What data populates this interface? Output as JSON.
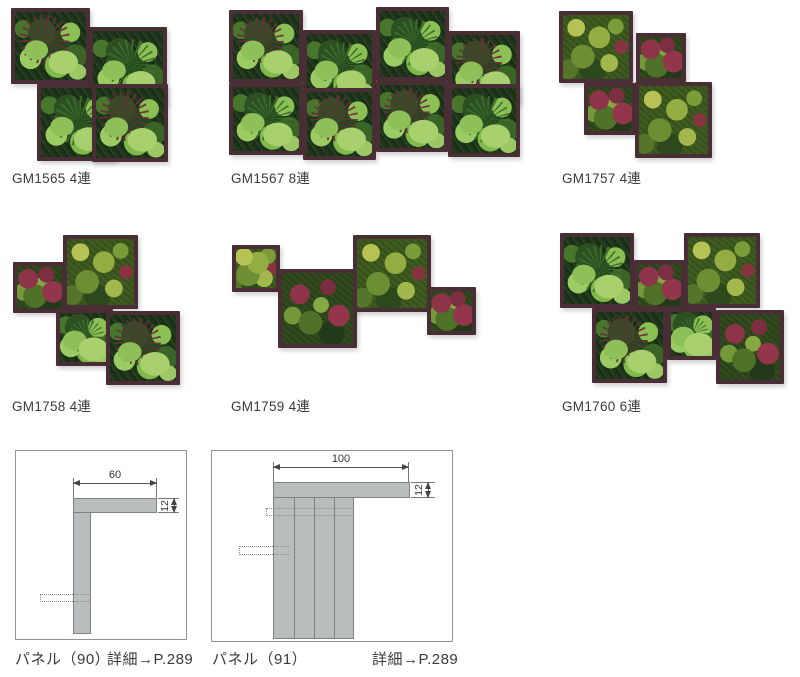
{
  "colors": {
    "frame": "#4a2e35",
    "text": "#3a3a3a",
    "box_border": "#8f9497",
    "diagram_fill": "#b9bdbe",
    "diagram_stroke": "#7e8284",
    "foliage_palette": [
      "#1d3519",
      "#2d5022",
      "#47762c",
      "#7fb94a",
      "#9ccb63",
      "#b7c254",
      "#93ad42",
      "#6d2c3c",
      "#8d3448",
      "#93354b"
    ]
  },
  "products": [
    {
      "code_label": "GM1565 4連",
      "label_pos": {
        "x": 12,
        "y": 167
      },
      "tiles": [
        {
          "x": 11,
          "y": 8,
          "w": 79,
          "h": 76,
          "variant": "jungle",
          "spike": "red"
        },
        {
          "x": 89,
          "y": 27,
          "w": 78,
          "h": 78,
          "variant": "jungle",
          "spike": "green"
        },
        {
          "x": 37,
          "y": 84,
          "w": 78,
          "h": 77,
          "variant": "jungle",
          "spike": "green"
        },
        {
          "x": 92,
          "y": 84,
          "w": 76,
          "h": 78,
          "variant": "jungle",
          "spike": "red"
        }
      ]
    },
    {
      "code_label": "GM1567 8連",
      "label_pos": {
        "x": 231,
        "y": 167
      },
      "tiles": [
        {
          "x": 229,
          "y": 10,
          "w": 74,
          "h": 73,
          "variant": "jungle",
          "spike": "red"
        },
        {
          "x": 303,
          "y": 30,
          "w": 73,
          "h": 73,
          "variant": "jungle",
          "spike": "green"
        },
        {
          "x": 376,
          "y": 7,
          "w": 73,
          "h": 74,
          "variant": "jungle",
          "spike": "green"
        },
        {
          "x": 448,
          "y": 31,
          "w": 72,
          "h": 73,
          "variant": "jungle",
          "spike": "red"
        },
        {
          "x": 229,
          "y": 83,
          "w": 74,
          "h": 72,
          "variant": "jungle",
          "spike": "green"
        },
        {
          "x": 303,
          "y": 88,
          "w": 73,
          "h": 72,
          "variant": "jungle",
          "spike": "red"
        },
        {
          "x": 376,
          "y": 81,
          "w": 72,
          "h": 71,
          "variant": "jungle",
          "spike": "red"
        },
        {
          "x": 448,
          "y": 84,
          "w": 72,
          "h": 73,
          "variant": "jungle",
          "spike": "green"
        }
      ]
    },
    {
      "code_label": "GM1757 4連",
      "label_pos": {
        "x": 562,
        "y": 167
      },
      "tiles": [
        {
          "x": 559,
          "y": 11,
          "w": 74,
          "h": 72,
          "variant": "moss",
          "spike": null
        },
        {
          "x": 636,
          "y": 33,
          "w": 50,
          "h": 49,
          "variant": "mossred",
          "spike": null
        },
        {
          "x": 584,
          "y": 83,
          "w": 52,
          "h": 52,
          "variant": "mossred",
          "spike": null
        },
        {
          "x": 635,
          "y": 82,
          "w": 77,
          "h": 76,
          "variant": "moss",
          "spike": null
        }
      ]
    },
    {
      "code_label": "GM1758 4連",
      "label_pos": {
        "x": 12,
        "y": 395
      },
      "tiles": [
        {
          "x": 13,
          "y": 262,
          "w": 53,
          "h": 51,
          "variant": "mossred",
          "spike": null
        },
        {
          "x": 63,
          "y": 235,
          "w": 75,
          "h": 74,
          "variant": "moss",
          "spike": null
        },
        {
          "x": 56,
          "y": 309,
          "w": 57,
          "h": 57,
          "variant": "jungle",
          "spike": "green"
        },
        {
          "x": 106,
          "y": 311,
          "w": 74,
          "h": 74,
          "variant": "jungle",
          "spike": "red"
        }
      ]
    },
    {
      "code_label": "GM1759 4連",
      "label_pos": {
        "x": 231,
        "y": 395
      },
      "tiles": [
        {
          "x": 232,
          "y": 245,
          "w": 48,
          "h": 47,
          "variant": "moss",
          "spike": null
        },
        {
          "x": 278,
          "y": 269,
          "w": 79,
          "h": 79,
          "variant": "mossred",
          "spike": null
        },
        {
          "x": 353,
          "y": 235,
          "w": 78,
          "h": 77,
          "variant": "moss",
          "spike": null
        },
        {
          "x": 427,
          "y": 287,
          "w": 49,
          "h": 48,
          "variant": "mossred",
          "spike": null
        }
      ]
    },
    {
      "code_label": "GM1760 6連",
      "label_pos": {
        "x": 562,
        "y": 395
      },
      "tiles": [
        {
          "x": 560,
          "y": 233,
          "w": 74,
          "h": 75,
          "variant": "jungle",
          "spike": "green"
        },
        {
          "x": 634,
          "y": 260,
          "w": 51,
          "h": 50,
          "variant": "mossred",
          "spike": null
        },
        {
          "x": 684,
          "y": 233,
          "w": 76,
          "h": 75,
          "variant": "moss",
          "spike": null
        },
        {
          "x": 592,
          "y": 308,
          "w": 75,
          "h": 75,
          "variant": "jungle",
          "spike": "red"
        },
        {
          "x": 667,
          "y": 308,
          "w": 49,
          "h": 52,
          "variant": "jungle",
          "spike": "green"
        },
        {
          "x": 716,
          "y": 310,
          "w": 68,
          "h": 74,
          "variant": "mossred",
          "spike": null
        }
      ]
    }
  ],
  "diagrams": [
    {
      "name_label": "パネル（90）",
      "detail_label": "詳細→P.289",
      "width_dim": "60",
      "thickness_dim": "12"
    },
    {
      "name_label": "パネル（91）",
      "detail_label": "詳細→P.289",
      "width_dim": "100",
      "thickness_dim": "12"
    }
  ]
}
